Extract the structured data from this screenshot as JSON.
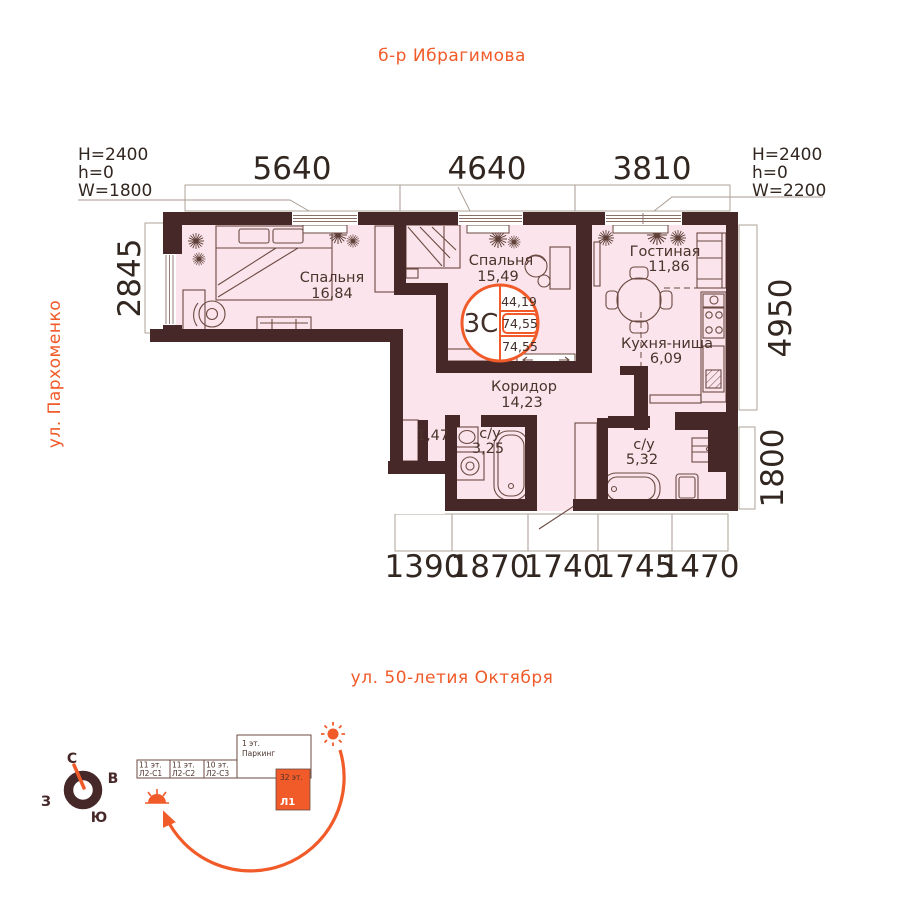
{
  "streets": {
    "top": "б-р Ибрагимова",
    "left": "ул. Пархоменко",
    "bottom": "ул. 50-летия Октября"
  },
  "window_specs": {
    "left": {
      "l1": "H=2400",
      "l2": "h=0",
      "l3": "W=1800"
    },
    "right": {
      "l1": "H=2400",
      "l2": "h=0",
      "l3": "W=2200"
    }
  },
  "dims": {
    "top1": "5640",
    "top2": "4640",
    "top3": "3810",
    "left1": "2845",
    "right1": "4950",
    "right2": "1800",
    "bottom1": "1390",
    "bottom2": "1870",
    "bottom3": "1740",
    "bottom4": "1745",
    "bottom5": "1470"
  },
  "unit": {
    "type": "3С",
    "area_living": "44,19",
    "area_total": "74,55",
    "area_full": "74,55"
  },
  "rooms": {
    "bedroom1": {
      "name": "Спальня",
      "area": "16,84"
    },
    "bedroom2": {
      "name": "Спальня",
      "area": "15,49"
    },
    "living": {
      "name": "Гостиная",
      "area": "11,86"
    },
    "kitchen": {
      "name": "Кухня-ниша",
      "area": "6,09"
    },
    "corridor": {
      "name": "Коридор",
      "area": "14,23"
    },
    "bath_small": {
      "name": "с/у",
      "area": "3,25"
    },
    "bath_big": {
      "name": "с/у",
      "area": "5,32"
    },
    "closet": {
      "area": "1,47"
    }
  },
  "compass": {
    "n": "С",
    "e": "В",
    "s": "Ю",
    "w": "З"
  },
  "site": {
    "s1_floors": "11 эт.",
    "s1_name": "Л2-С1",
    "s2_floors": "11 эт.",
    "s2_name": "Л2-С2",
    "s3_floors": "10 эт.",
    "s3_name": "Л2-С3",
    "parking_floors": "1 эт.",
    "parking_name": "Паркинг",
    "tower_floors": "32 эт.",
    "tower_name": "Л1"
  },
  "colors": {
    "wall": "#472829",
    "floor": "#fbe4ec",
    "accent": "#f15a29"
  }
}
